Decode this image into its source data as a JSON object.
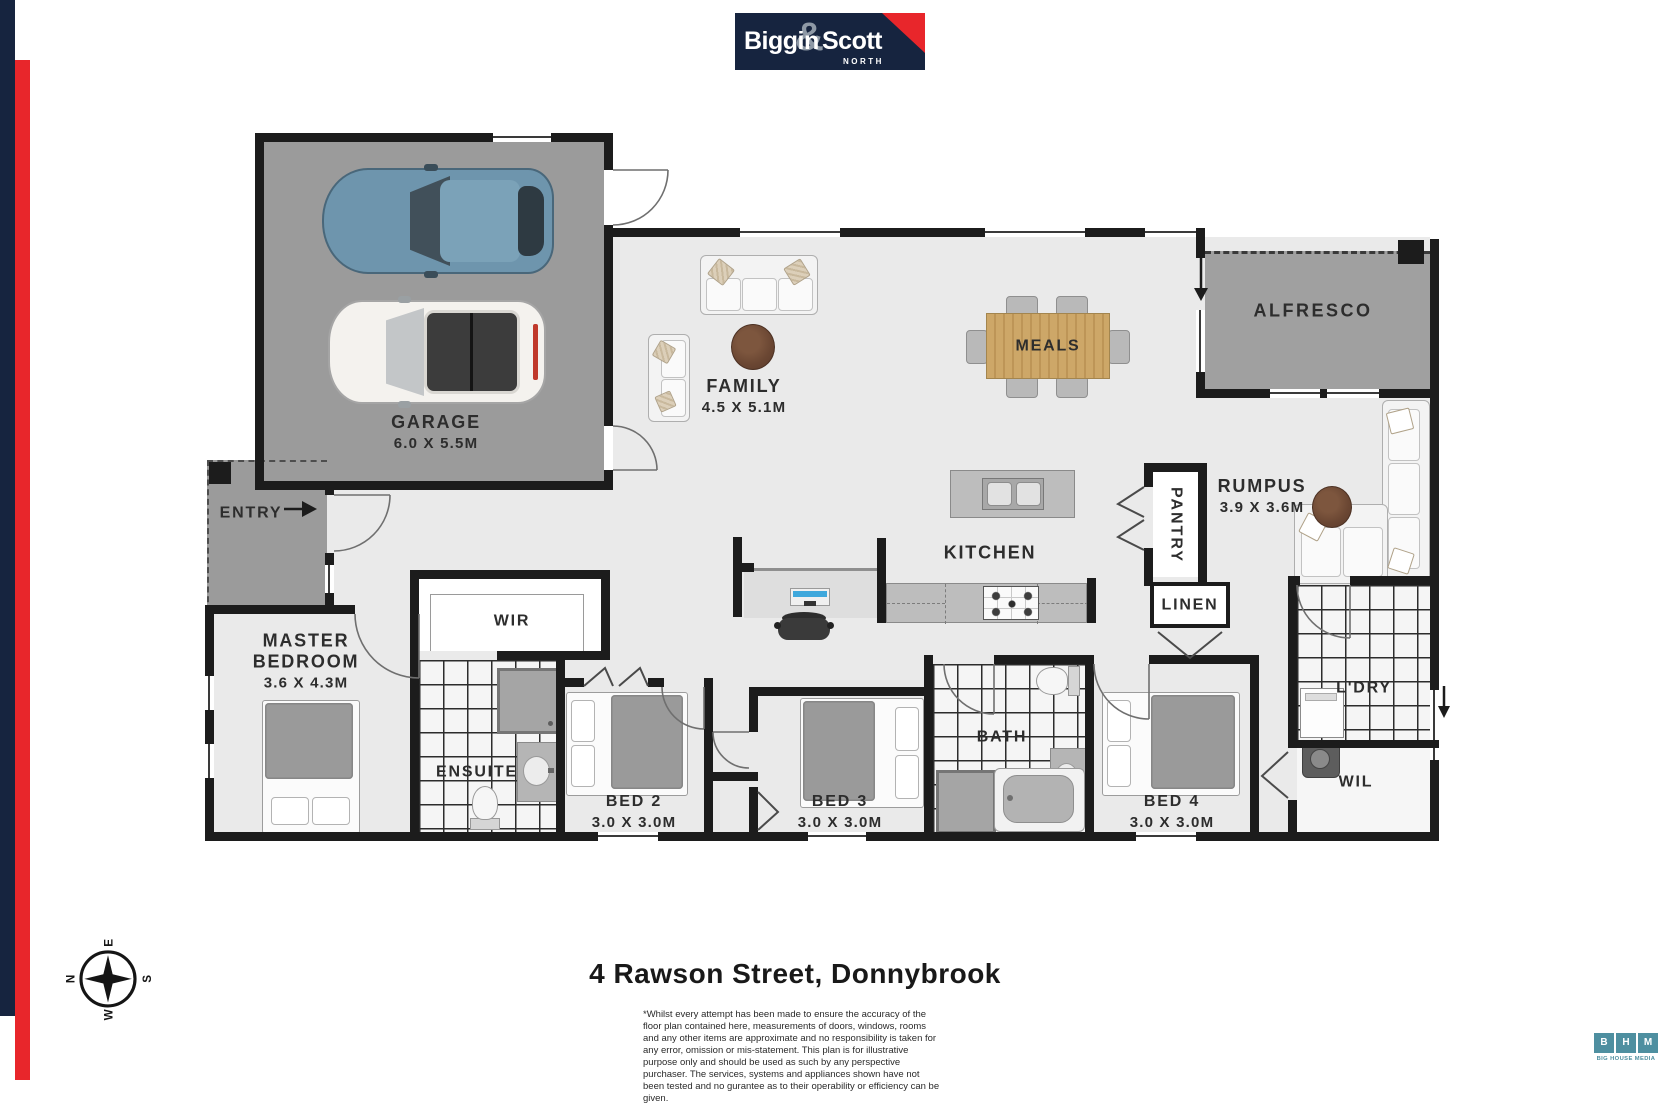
{
  "brand": {
    "name_a": "Biggin",
    "amp": "&",
    "name_b": "Scott",
    "region": "NORTH"
  },
  "plan": {
    "garage": {
      "line1": "GARAGE",
      "line2": "6.0 X 5.5M"
    },
    "entry": {
      "line1": "ENTRY"
    },
    "family": {
      "line1": "FAMILY",
      "line2": "4.5 X 5.1M"
    },
    "meals": {
      "line1": "MEALS"
    },
    "alfresco": {
      "line1": "ALFRESCO"
    },
    "kitchen": {
      "line1": "KITCHEN"
    },
    "pantry": {
      "line1": "PANTRY"
    },
    "linen": {
      "line1": "LINEN"
    },
    "rumpus": {
      "line1": "RUMPUS",
      "line2": "3.9 X 3.6M"
    },
    "wir": {
      "line1": "WIR"
    },
    "master": {
      "line1": "MASTER",
      "line2": "BEDROOM",
      "line3": "3.6 X 4.3M"
    },
    "ensuite": {
      "line1": "ENSUITE"
    },
    "bed2": {
      "line1": "BED 2",
      "line2": "3.0 X 3.0M"
    },
    "bed3": {
      "line1": "BED 3",
      "line2": "3.0 X 3.0M"
    },
    "bath": {
      "line1": "BATH"
    },
    "bed4": {
      "line1": "BED 4",
      "line2": "3.0 X 3.0M"
    },
    "ldry": {
      "line1": "L'DRY"
    },
    "wil": {
      "line1": "WIL"
    }
  },
  "compass": {
    "n": "N",
    "e": "E",
    "s": "S",
    "w": "W"
  },
  "footer": {
    "address": "4 Rawson Street, Donnybrook",
    "disclaimer": "*Whilst every attempt has been made to ensure the accuracy of the floor plan contained here, measurements of doors, windows, rooms and any other items are approximate and no responsibility is taken for any error, omission or mis-statement. This plan is for illustrative purpose only and should be used as such by any perspective purchaser. The services, systems and appliances shown have not been tested and no gurantee as to their operability or efficiency can be given."
  },
  "watermark": {
    "b": "B",
    "h": "H",
    "m": "M",
    "caption": "BIG HOUSE MEDIA"
  },
  "colors": {
    "navy": "#16243f",
    "red": "#e8262b",
    "wall": "#1c1c1c",
    "floor": "#eaeaea",
    "outdoor": "#9b9b9b",
    "teal": "#4e8fa0",
    "wood": "#c9a063"
  }
}
